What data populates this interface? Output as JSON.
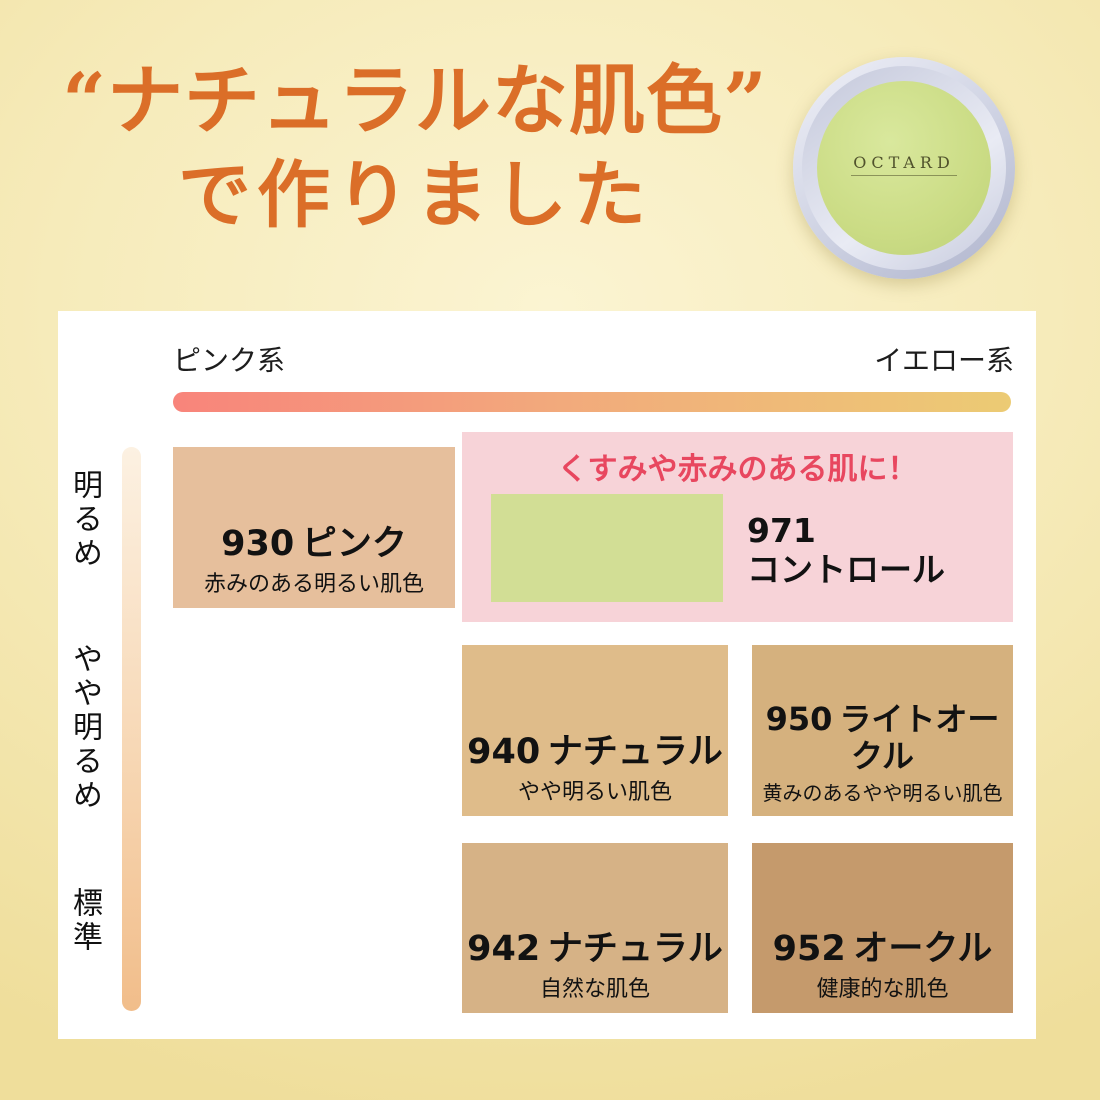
{
  "page": {
    "background_center": "#FBF4D2",
    "background_edge": "#EFDE9B"
  },
  "header": {
    "title_line1": "“ナチュラルな肌色”",
    "title_line2": "で作りました",
    "title_color": "#DB6E28"
  },
  "product": {
    "brand_logo": "OCTARD",
    "face_color": "#CBDC85",
    "rim_color": "#C6CADD"
  },
  "chart": {
    "x_axis": {
      "left_label": "ピンク系",
      "right_label": "イエロー系",
      "bar_gradient_from": "#F8847B",
      "bar_gradient_to": "#ECCB74"
    },
    "y_axis": {
      "labels": [
        "明るめ",
        "やや明るめ",
        "標準"
      ],
      "bar_gradient_from": "#FCF1E2",
      "bar_gradient_to": "#F1BD8A"
    },
    "highlight": {
      "caption": "くすみや赤みのある肌に！",
      "caption_color": "#E8475F",
      "box_color": "#F7D3D8",
      "code": "971",
      "name": "コントロール",
      "swatch_color": "#D2DE95"
    },
    "shades": [
      {
        "code": "930",
        "name": "ピンク",
        "desc": "赤みのある明るい肌色",
        "color": "#E6BF9C"
      },
      {
        "code": "940",
        "name": "ナチュラル",
        "desc": "やや明るい肌色",
        "color": "#DFBC8A"
      },
      {
        "code": "950",
        "name": "ライトオークル",
        "desc": "黄みのあるやや明るい肌色",
        "color": "#D5B17E"
      },
      {
        "code": "942",
        "name": "ナチュラル",
        "desc": "自然な肌色",
        "color": "#D6B286"
      },
      {
        "code": "952",
        "name": "オークル",
        "desc": "健康的な肌色",
        "color": "#C59A6C"
      }
    ]
  }
}
